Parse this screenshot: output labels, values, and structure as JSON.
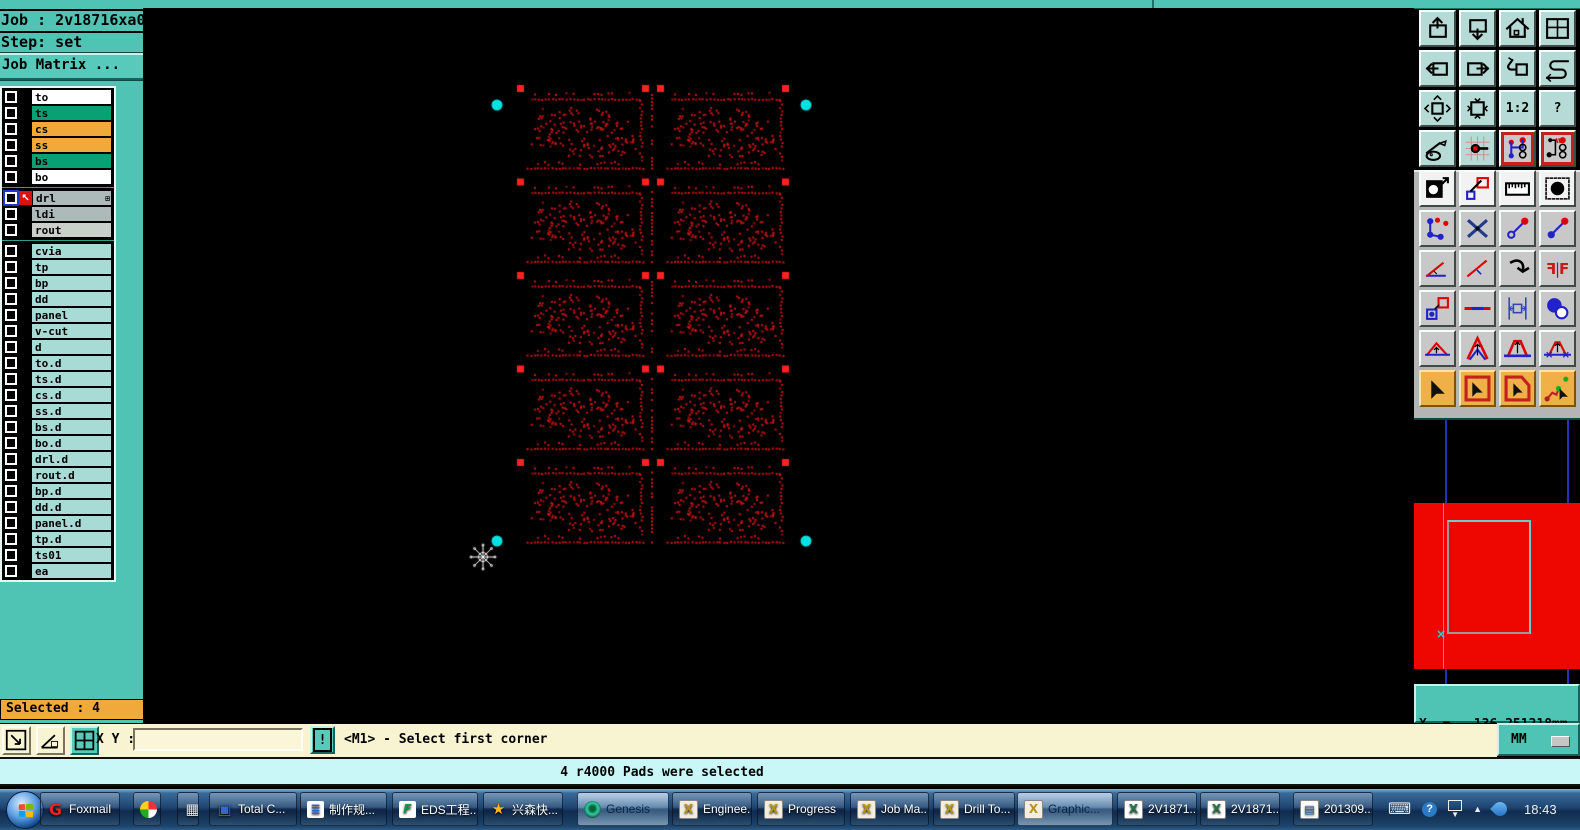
{
  "palette": {
    "teal": "#4fc4b4",
    "teal_dark": "#1d6e63",
    "cream": "#f8f3d1",
    "orange": "#f2a93b",
    "message_cyan": "#c9f7f7",
    "canvas_dot_red": "#d01414",
    "canvas_pad_red": "#ff2020",
    "select_cyan": "#00e2e2",
    "preview_red": "#ee0600",
    "taskbar_blue": "#1d4470"
  },
  "job_panel": {
    "job": "Job : 2v18716xa0",
    "step": "Step: set",
    "matrix_button": "Job Matrix ..."
  },
  "layer_list": {
    "groups": [
      {
        "rows": [
          {
            "label": "to",
            "bg": "#ffffff"
          },
          {
            "label": "ts",
            "bg": "#07a173"
          },
          {
            "label": "cs",
            "bg": "#f2a93b"
          },
          {
            "label": "ss",
            "bg": "#f2a93b"
          },
          {
            "label": "bs",
            "bg": "#07a173"
          },
          {
            "label": "bo",
            "bg": "#ffffff"
          }
        ]
      },
      {
        "rows": [
          {
            "label": "drl",
            "bg": "#aeb9ba",
            "selected": true,
            "has_matrix_icon": true
          },
          {
            "label": "ldi",
            "bg": "#aeb9ba"
          },
          {
            "label": "rout",
            "bg": "#c9cfc9"
          }
        ]
      },
      {
        "rows": [
          {
            "label": "cvia",
            "bg": "#a8dbd6"
          },
          {
            "label": "tp",
            "bg": "#a8dbd6"
          },
          {
            "label": "bp",
            "bg": "#a8dbd6"
          },
          {
            "label": "dd",
            "bg": "#a8dbd6"
          },
          {
            "label": "panel",
            "bg": "#a8dbd6"
          },
          {
            "label": "v-cut",
            "bg": "#a8dbd6"
          },
          {
            "label": "d",
            "bg": "#a8dbd6"
          },
          {
            "label": "to.d",
            "bg": "#a8dbd6"
          },
          {
            "label": "ts.d",
            "bg": "#a8dbd6"
          },
          {
            "label": "cs.d",
            "bg": "#a8dbd6"
          },
          {
            "label": "ss.d",
            "bg": "#a8dbd6"
          },
          {
            "label": "bs.d",
            "bg": "#a8dbd6"
          },
          {
            "label": "bo.d",
            "bg": "#a8dbd6"
          },
          {
            "label": "drl.d",
            "bg": "#a8dbd6"
          },
          {
            "label": "rout.d",
            "bg": "#a8dbd6"
          },
          {
            "label": "bp.d",
            "bg": "#a8dbd6"
          },
          {
            "label": "dd.d",
            "bg": "#a8dbd6"
          },
          {
            "label": "panel.d",
            "bg": "#a8dbd6"
          },
          {
            "label": "tp.d",
            "bg": "#a8dbd6"
          },
          {
            "label": "ts01",
            "bg": "#a8dbd6"
          },
          {
            "label": "ea",
            "bg": "#a8dbd6"
          }
        ]
      }
    ],
    "matrix_icon": "⊞",
    "work_arrow": "↖"
  },
  "selected_box": {
    "label": "Selected : 4"
  },
  "command_bar": {
    "xy_label": "X Y :",
    "input_value": "",
    "alert": "!",
    "status": "<M1> - Select first corner",
    "units": "MM"
  },
  "message_bar": {
    "text": "4 r4000 Pads were selected"
  },
  "coords_readout": {
    "x": "X  =  -136.251218mm",
    "y": "Y  =  204.520770mm"
  },
  "toolbar_right": {
    "buttons": [
      {
        "name": "zoom-previous",
        "g": "g1"
      },
      {
        "name": "zoom-window",
        "g": "g1"
      },
      {
        "name": "home-view",
        "g": "g1"
      },
      {
        "name": "windows-xy",
        "g": "g1"
      },
      {
        "name": "shift-left",
        "g": "g1"
      },
      {
        "name": "shift-right",
        "g": "g1"
      },
      {
        "name": "undo-view",
        "g": "g1"
      },
      {
        "name": "serpentine",
        "g": "g1"
      },
      {
        "name": "zoom-out-fit",
        "g": "g1"
      },
      {
        "name": "zoom-in-center",
        "g": "g1"
      },
      {
        "name": "scale-1-2",
        "g": "g1",
        "text": "1:2"
      },
      {
        "name": "help",
        "g": "g1",
        "text": "?"
      },
      {
        "name": "setup-tools",
        "g": "g1"
      },
      {
        "name": "origin-pad",
        "g": "g1"
      },
      {
        "name": "net-highlight-a",
        "g": "redframe"
      },
      {
        "name": "net-highlight-b",
        "g": "redframe"
      },
      {
        "name": "invert-image",
        "g": "g2"
      },
      {
        "name": "edit-shapes",
        "g": "g2"
      },
      {
        "name": "measure-ruler",
        "g": "g2"
      },
      {
        "name": "select-pad",
        "g": "g2"
      },
      {
        "name": "chain-nets",
        "g": "g3"
      },
      {
        "name": "delete-feature",
        "g": "g3"
      },
      {
        "name": "move-to-pad",
        "g": "g3"
      },
      {
        "name": "copy-to-pad",
        "g": "g3"
      },
      {
        "name": "measure-angle",
        "g": "g3"
      },
      {
        "name": "measure-slope",
        "g": "g3"
      },
      {
        "name": "rotate-feature",
        "g": "g3"
      },
      {
        "name": "mirror-feature",
        "g": "g3",
        "text": "F"
      },
      {
        "name": "copy-layer-pad",
        "g": "g3"
      },
      {
        "name": "stretch-trace",
        "g": "g3"
      },
      {
        "name": "measure-gap",
        "g": "g3"
      },
      {
        "name": "touch-circles",
        "g": "g3"
      },
      {
        "name": "triangle-height",
        "g": "g3"
      },
      {
        "name": "triangle-peak",
        "g": "g3"
      },
      {
        "name": "triangle-base",
        "g": "g3"
      },
      {
        "name": "triangle-span",
        "g": "g3"
      },
      {
        "name": "select-single",
        "g": "g4"
      },
      {
        "name": "select-frame",
        "g": "g4"
      },
      {
        "name": "select-polygon",
        "g": "g4"
      },
      {
        "name": "select-net",
        "g": "g4"
      }
    ]
  },
  "taskbar": {
    "items": [
      {
        "label": "Foxmail",
        "icon": "foxmail"
      },
      {
        "label": "",
        "icon": "pinwheel"
      },
      {
        "label": "",
        "icon": "calculator"
      },
      {
        "label": "Total C...",
        "icon": "floppy"
      },
      {
        "label": "制作规...",
        "icon": "doc-blue"
      },
      {
        "label": "EDS工程...",
        "icon": "f-green"
      },
      {
        "label": "兴森快...",
        "icon": "star"
      },
      {
        "label": "Genesis",
        "icon": "genesis",
        "active": true
      },
      {
        "label": "Enginee...",
        "icon": "x-app"
      },
      {
        "label": "Progress",
        "icon": "x-app"
      },
      {
        "label": "Job Ma...",
        "icon": "x-app"
      },
      {
        "label": "Drill To...",
        "icon": "x-app"
      },
      {
        "label": "Graphic...",
        "icon": "x-app",
        "active": true
      },
      {
        "label": "2V1871...",
        "icon": "excel"
      },
      {
        "label": "2V1871...",
        "icon": "excel"
      },
      {
        "label": "201309...",
        "icon": "word"
      }
    ],
    "clock": "18:43"
  },
  "canvas_pattern": {
    "canvas_left": 143,
    "canvas_top": 8,
    "origin_x": 520,
    "origin_y": 88,
    "cols": 2,
    "rows": 5,
    "tile_w": 125,
    "tile_h": 86,
    "pitch_x": 140,
    "pitch_y": 93.5,
    "dot_color": "#d01414",
    "dot_color_alt": "#a80e0e",
    "pad_color": "#ff2020",
    "select_color": "#00e2e2",
    "selected_pads": [
      [
        497,
        105
      ],
      [
        806,
        105
      ],
      [
        497,
        541
      ],
      [
        806,
        541
      ]
    ],
    "cursor": [
      483,
      557
    ]
  }
}
